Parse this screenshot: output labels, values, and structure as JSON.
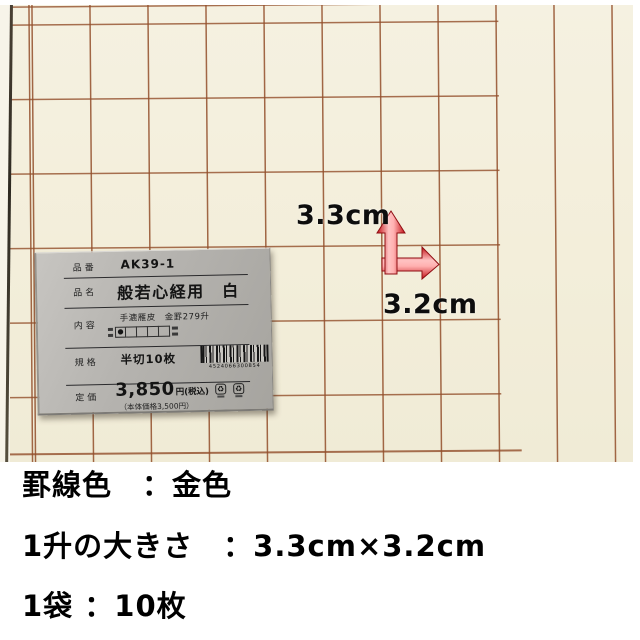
{
  "photo": {
    "dimension_labels": {
      "vertical": "3.3cm",
      "horizontal": "3.2cm"
    },
    "arrow_color": "#d21419",
    "grid_line_color": "#924e2a",
    "paper_color": "#f3eeda"
  },
  "label_card": {
    "fields": [
      {
        "label": "品番",
        "value": "AK39-1"
      },
      {
        "label": "品名",
        "value": "般若心経用　白"
      },
      {
        "label": "内容",
        "value": "手漉雁皮　金罫279升",
        "check_dot": "●"
      },
      {
        "label": "規格",
        "value": "半切10枚",
        "barcode_number": "4524066300854"
      },
      {
        "label": "定価",
        "price": "3,850",
        "price_unit": "円(税込)",
        "price_note": "（本体価格3,500円）"
      }
    ]
  },
  "specs": [
    {
      "text": "罫線色　：金色"
    },
    {
      "text": "1升の大きさ　：3.3cm×3.2cm"
    },
    {
      "text": "1袋 ：10枚"
    }
  ]
}
